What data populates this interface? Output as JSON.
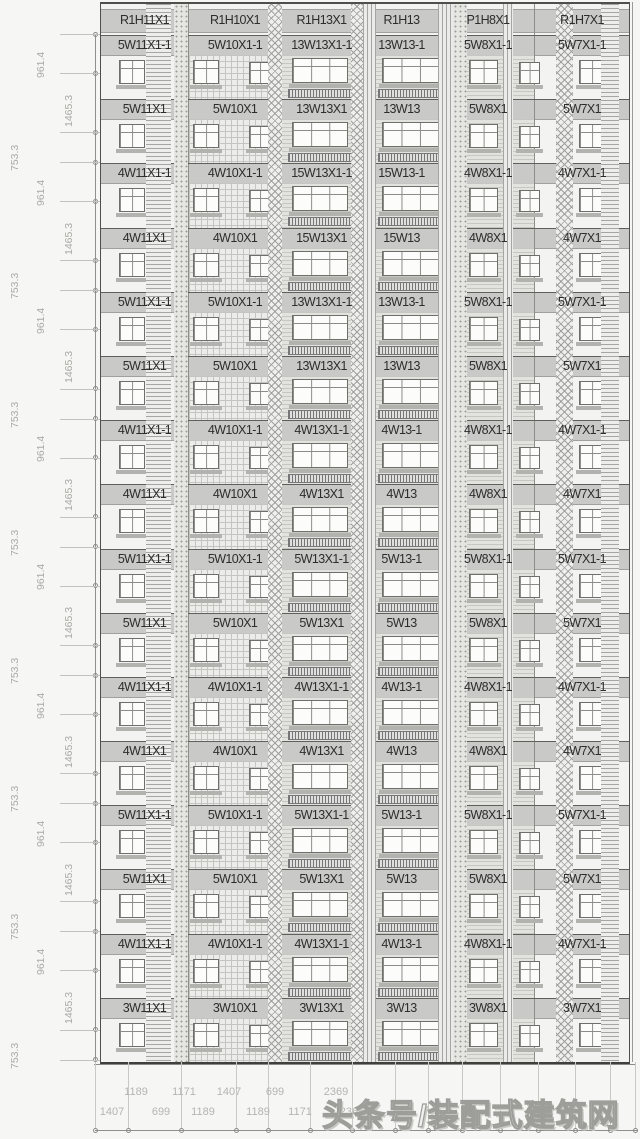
{
  "elevation": {
    "header": [
      "R1H11X1",
      "R1H10X1",
      "R1H13X1",
      "R1H13",
      "P1H8X1",
      "R1H7X1"
    ],
    "floors": [
      [
        "5W11X1-1",
        "5W10X1-1",
        "13W13X1-1",
        "13W13-1",
        "5W8X1-1",
        "5W7X1-1"
      ],
      [
        "5W11X1",
        "5W10X1",
        "13W13X1",
        "13W13",
        "5W8X1",
        "5W7X1"
      ],
      [
        "4W11X1-1",
        "4W10X1-1",
        "15W13X1-1",
        "15W13-1",
        "4W8X1-1",
        "4W7X1-1"
      ],
      [
        "4W11X1",
        "4W10X1",
        "15W13X1",
        "15W13",
        "4W8X1",
        "4W7X1"
      ],
      [
        "5W11X1-1",
        "5W10X1-1",
        "13W13X1-1",
        "13W13-1",
        "5W8X1-1",
        "5W7X1-1"
      ],
      [
        "5W11X1",
        "5W10X1",
        "13W13X1",
        "13W13",
        "5W8X1",
        "5W7X1"
      ],
      [
        "4W11X1-1",
        "4W10X1-1",
        "4W13X1-1",
        "4W13-1",
        "4W8X1-1",
        "4W7X1-1"
      ],
      [
        "4W11X1",
        "4W10X1",
        "4W13X1",
        "4W13",
        "4W8X1",
        "4W7X1"
      ],
      [
        "5W11X1-1",
        "5W10X1-1",
        "5W13X1-1",
        "5W13-1",
        "5W8X1-1",
        "5W7X1-1"
      ],
      [
        "5W11X1",
        "5W10X1",
        "5W13X1",
        "5W13",
        "5W8X1",
        "5W7X1"
      ],
      [
        "4W11X1-1",
        "4W10X1-1",
        "4W13X1-1",
        "4W13-1",
        "4W8X1-1",
        "4W7X1-1"
      ],
      [
        "4W11X1",
        "4W10X1",
        "4W13X1",
        "4W13",
        "4W8X1",
        "4W7X1"
      ],
      [
        "5W11X1-1",
        "5W10X1-1",
        "5W13X1-1",
        "5W13-1",
        "5W8X1-1",
        "5W7X1-1"
      ],
      [
        "5W11X1",
        "5W10X1",
        "5W13X1",
        "5W13",
        "5W8X1",
        "5W7X1"
      ],
      [
        "4W11X1-1",
        "4W10X1-1",
        "4W13X1-1",
        "4W13-1",
        "4W8X1-1",
        "4W7X1-1"
      ],
      [
        "3W11X1",
        "3W10X1",
        "3W13X1",
        "3W13",
        "3W8X1",
        "3W7X1"
      ]
    ]
  },
  "left_dims": {
    "values": [
      "961.4",
      "1465.3",
      "753.3",
      "961.4",
      "1465.3",
      "753.3",
      "961.4",
      "1465.3",
      "753.3",
      "961.4",
      "1465.3",
      "753.3",
      "961.4",
      "1465.3",
      "753.3",
      "961.4",
      "1465.3",
      "753.3",
      "961.4",
      "1465.3",
      "753.3",
      "961.4",
      "1465.3",
      "753.3"
    ]
  },
  "bottom_dims": {
    "upper": [
      "1189",
      "1171",
      "1407",
      "699",
      "2369"
    ],
    "lower": [
      "1407",
      "699",
      "1189",
      "1189",
      "1171",
      "2365"
    ]
  },
  "watermark": {
    "text": "头条号/装配式建筑网"
  },
  "colors": {
    "band": "#c9c9c7",
    "outline": "#4f4f4c",
    "dim_text": "#a9a9a5",
    "hatch": "#a0a09c",
    "background": "#f6f6f4"
  }
}
